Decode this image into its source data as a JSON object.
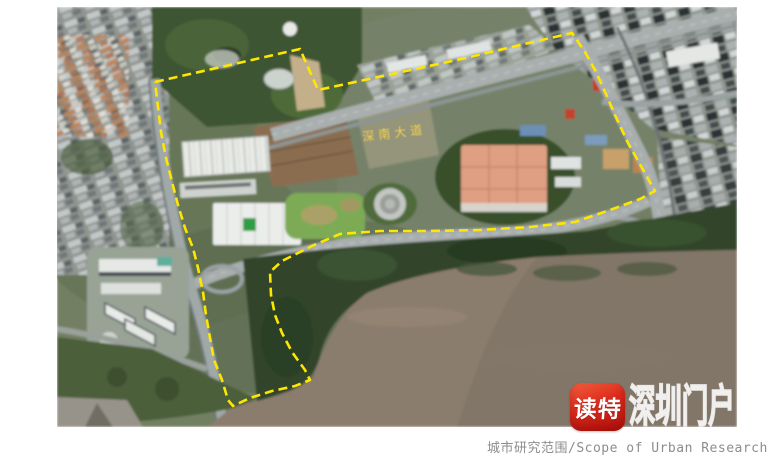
{
  "map": {
    "kind": "satellite-photo-with-study-area-annotation",
    "road_label": "深南大道",
    "boundary": {
      "color": "#ffe600",
      "style": "dashed",
      "points": "98,75 243,42 261,83 363,61 413,50 463,38 515,26 528,45 539,65 549,87 558,108 571,136 584,159 595,179 598,184 583,192 553,203 518,215 473,220 423,223 373,224 323,224 283,227 255,239 225,254 213,265 214,288 218,308 225,326 235,345 248,363 253,373 238,379 215,384 193,391 176,399 171,393 165,373 157,353 153,331 149,308 146,285 141,261 136,241 128,221 121,198 115,175 109,151 104,125 101,100 98,75"
    },
    "colors": {
      "water_mud": "#8b7d6d",
      "forest": "#31452b",
      "urban_gray": "#8f958f",
      "orange_complex": "#df9f82"
    }
  },
  "watermark": {
    "logo_text": "读特",
    "portal_text": "深圳门户",
    "logo_color": "#d7261d"
  },
  "caption": {
    "text": "城市研究范围/Scope of Urban Research",
    "color": "#8d8d8d"
  }
}
